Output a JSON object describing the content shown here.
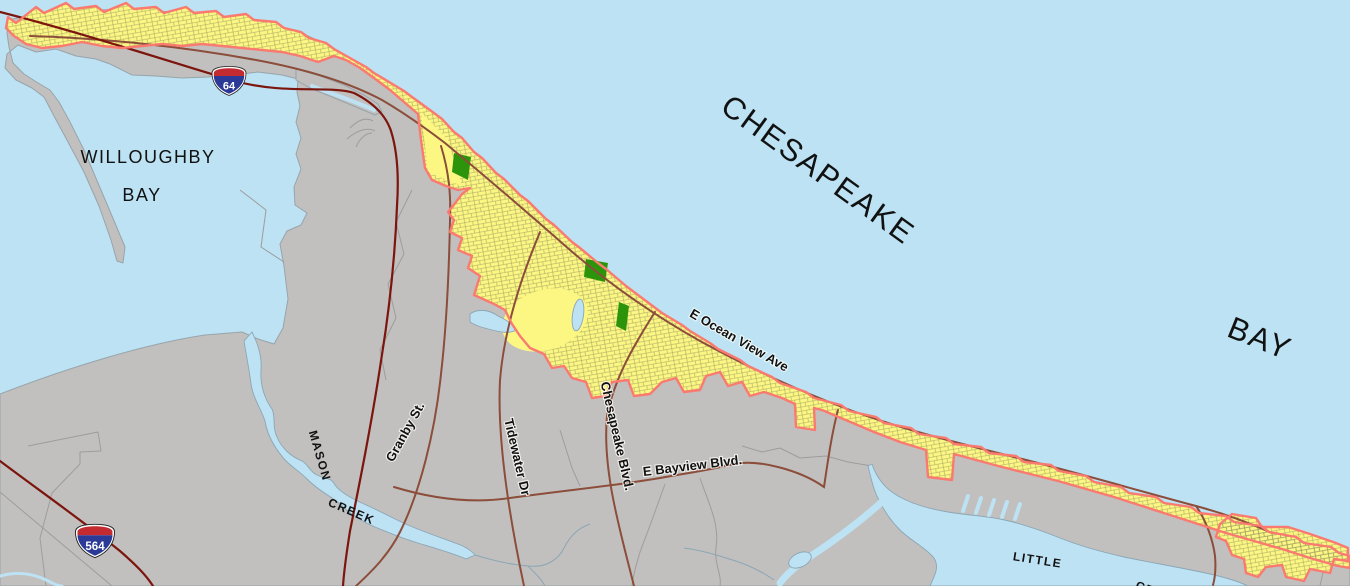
{
  "map": {
    "water_labels": {
      "willoughby": [
        "WILLOUGHBY",
        "BAY"
      ],
      "chesapeake": [
        "CHESAPEAKE",
        "BAY"
      ],
      "mason_creek": [
        "MASON",
        "CREEK"
      ],
      "little_creek": [
        "LITTLE",
        "CREEK"
      ]
    },
    "road_labels": {
      "ocean_view": "E Ocean View Ave",
      "granby": "Granby St.",
      "tidewater": "Tidewater Dr",
      "chesapeake_blvd": "Chesapeake Blvd.",
      "bayview": "E Bayview Blvd."
    },
    "highway_shields": {
      "i64": "64",
      "i564": "564"
    },
    "colors": {
      "water": "#BCE2F3",
      "water_line": "#8CA6B4",
      "land": "#C1C0BF",
      "land_line": "#98A4AA",
      "parcel_area": "#FCF782",
      "parcel_line": "#8E8E5E",
      "boundary": "#FA7A70",
      "interstate": "#7B150D",
      "road": "#8C4D3A",
      "minor": "#9D9D9D",
      "park": "#2C940A",
      "shield_red": "#C32B31",
      "shield_blue": "#2C3A97",
      "label": "#111111"
    }
  }
}
